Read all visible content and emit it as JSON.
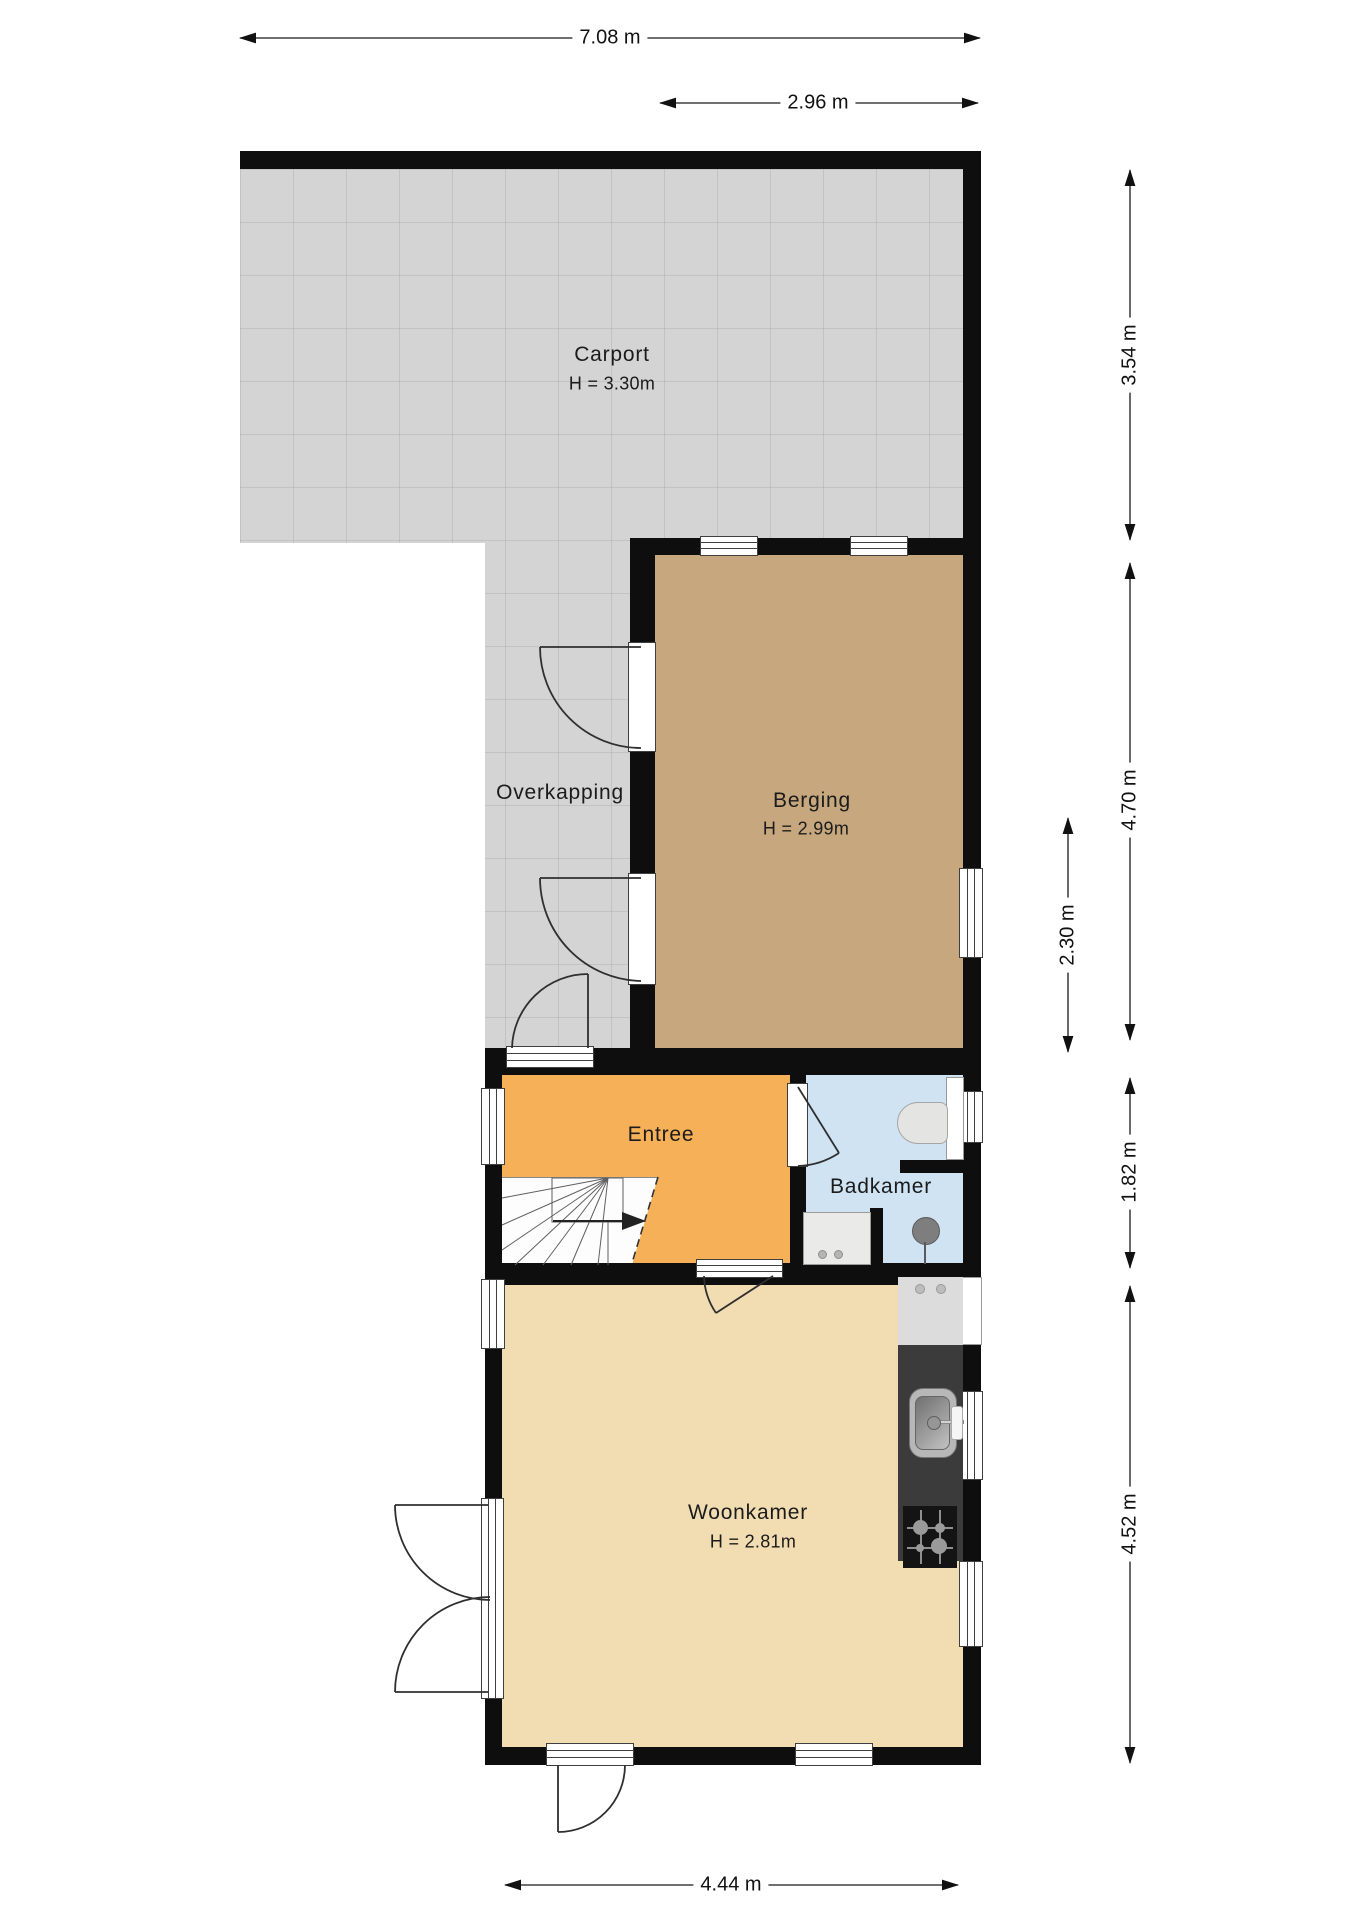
{
  "title": "Begane grond plattegrond",
  "rooms": [
    {
      "name": "Carport",
      "height_label": "H = 3.30m"
    },
    {
      "name": "Overkapping",
      "height_label": ""
    },
    {
      "name": "Berging",
      "height_label": "H = 2.99m"
    },
    {
      "name": "Entree",
      "height_label": ""
    },
    {
      "name": "Badkamer",
      "height_label": ""
    },
    {
      "name": "Woonkamer",
      "height_label": "H = 2.81m"
    }
  ],
  "dimensions": {
    "total_width": "7.08 m",
    "berging_width": "2.96 m",
    "carport_depth": "3.54 m",
    "berging_depth": "4.70 m",
    "berging_inner_depth": "2.30 m",
    "badkamer_depth": "1.82 m",
    "woonkamer_depth": "4.52 m",
    "woonkamer_width": "4.44 m"
  },
  "fixtures": [
    "toilet",
    "washbasin",
    "shower-drain",
    "kitchen-sink",
    "gas-hob",
    "stairs"
  ],
  "colors": {
    "wall": "#0e0e0e",
    "paving": "#d4d4d4",
    "berging-floor": "#c7a87e",
    "entree-floor": "#f6b158",
    "badkamer-floor": "#cfe3f2",
    "woonkamer-floor": "#f2dcb2",
    "counter-dark": "#3b3b3b",
    "counter-light": "#dcdcdc",
    "dim-line": "#1a1a1a"
  }
}
